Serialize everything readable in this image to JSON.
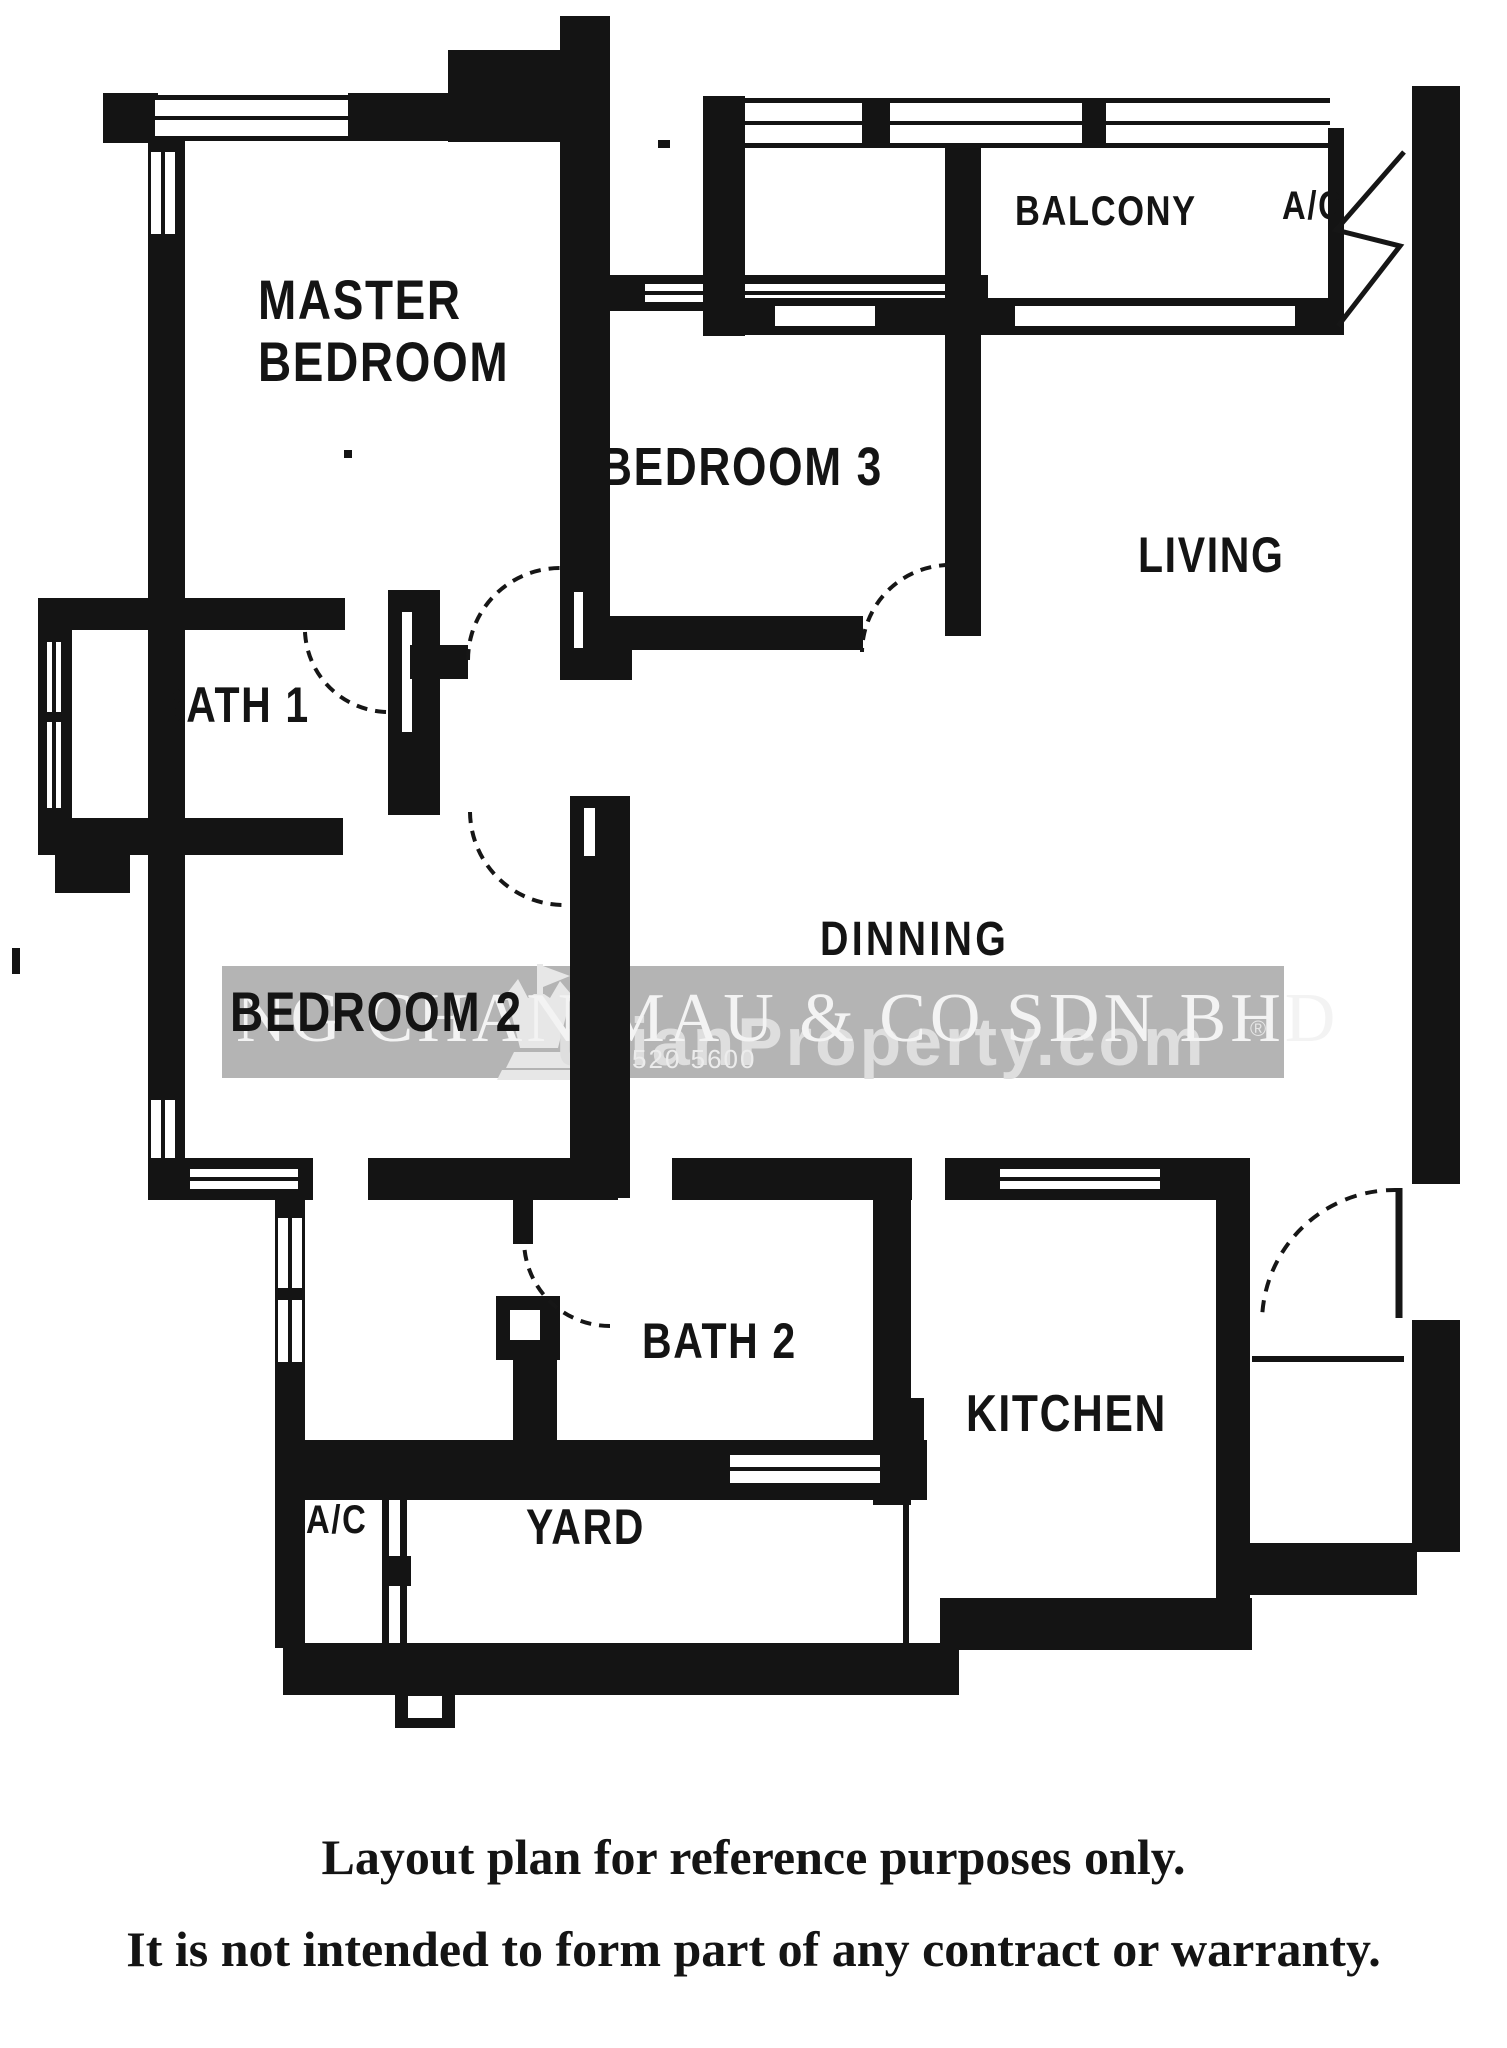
{
  "plan": {
    "rooms": {
      "master_bedroom": {
        "line1": "MASTER",
        "line2": "BEDROOM"
      },
      "bedroom_3": {
        "label": "BEDROOM 3"
      },
      "balcony": {
        "label": "BALCONY"
      },
      "ac_top": {
        "label": "A/C"
      },
      "living": {
        "label": "LIVING"
      },
      "bath_1": {
        "label": "BATH 1"
      },
      "dinning": {
        "label": "DINNING"
      },
      "bedroom_2": {
        "label": "BEDROOM 2"
      },
      "bath_2": {
        "label": "BATH 2"
      },
      "kitchen": {
        "label": "KITCHEN"
      },
      "yard": {
        "label": "YARD"
      },
      "ac_bottom": {
        "label": "A/C"
      }
    },
    "watermark": {
      "agency": "NG CHAN MAU & CO SDN BHD",
      "portal": "urianProperty.com",
      "phone": "012-520 5600",
      "registered": "®"
    },
    "disclaimer": {
      "line1": "Layout plan for reference purposes only.",
      "line2": "It is not intended to form part of any contract or warranty."
    },
    "colors": {
      "wall": "#141414",
      "watermark_band": "#b4b4b4",
      "watermark_agency_text": "#f3f3f3",
      "watermark_portal_text": "#dedede",
      "watermark_phone_text": "#ececec",
      "background": "#ffffff"
    }
  }
}
